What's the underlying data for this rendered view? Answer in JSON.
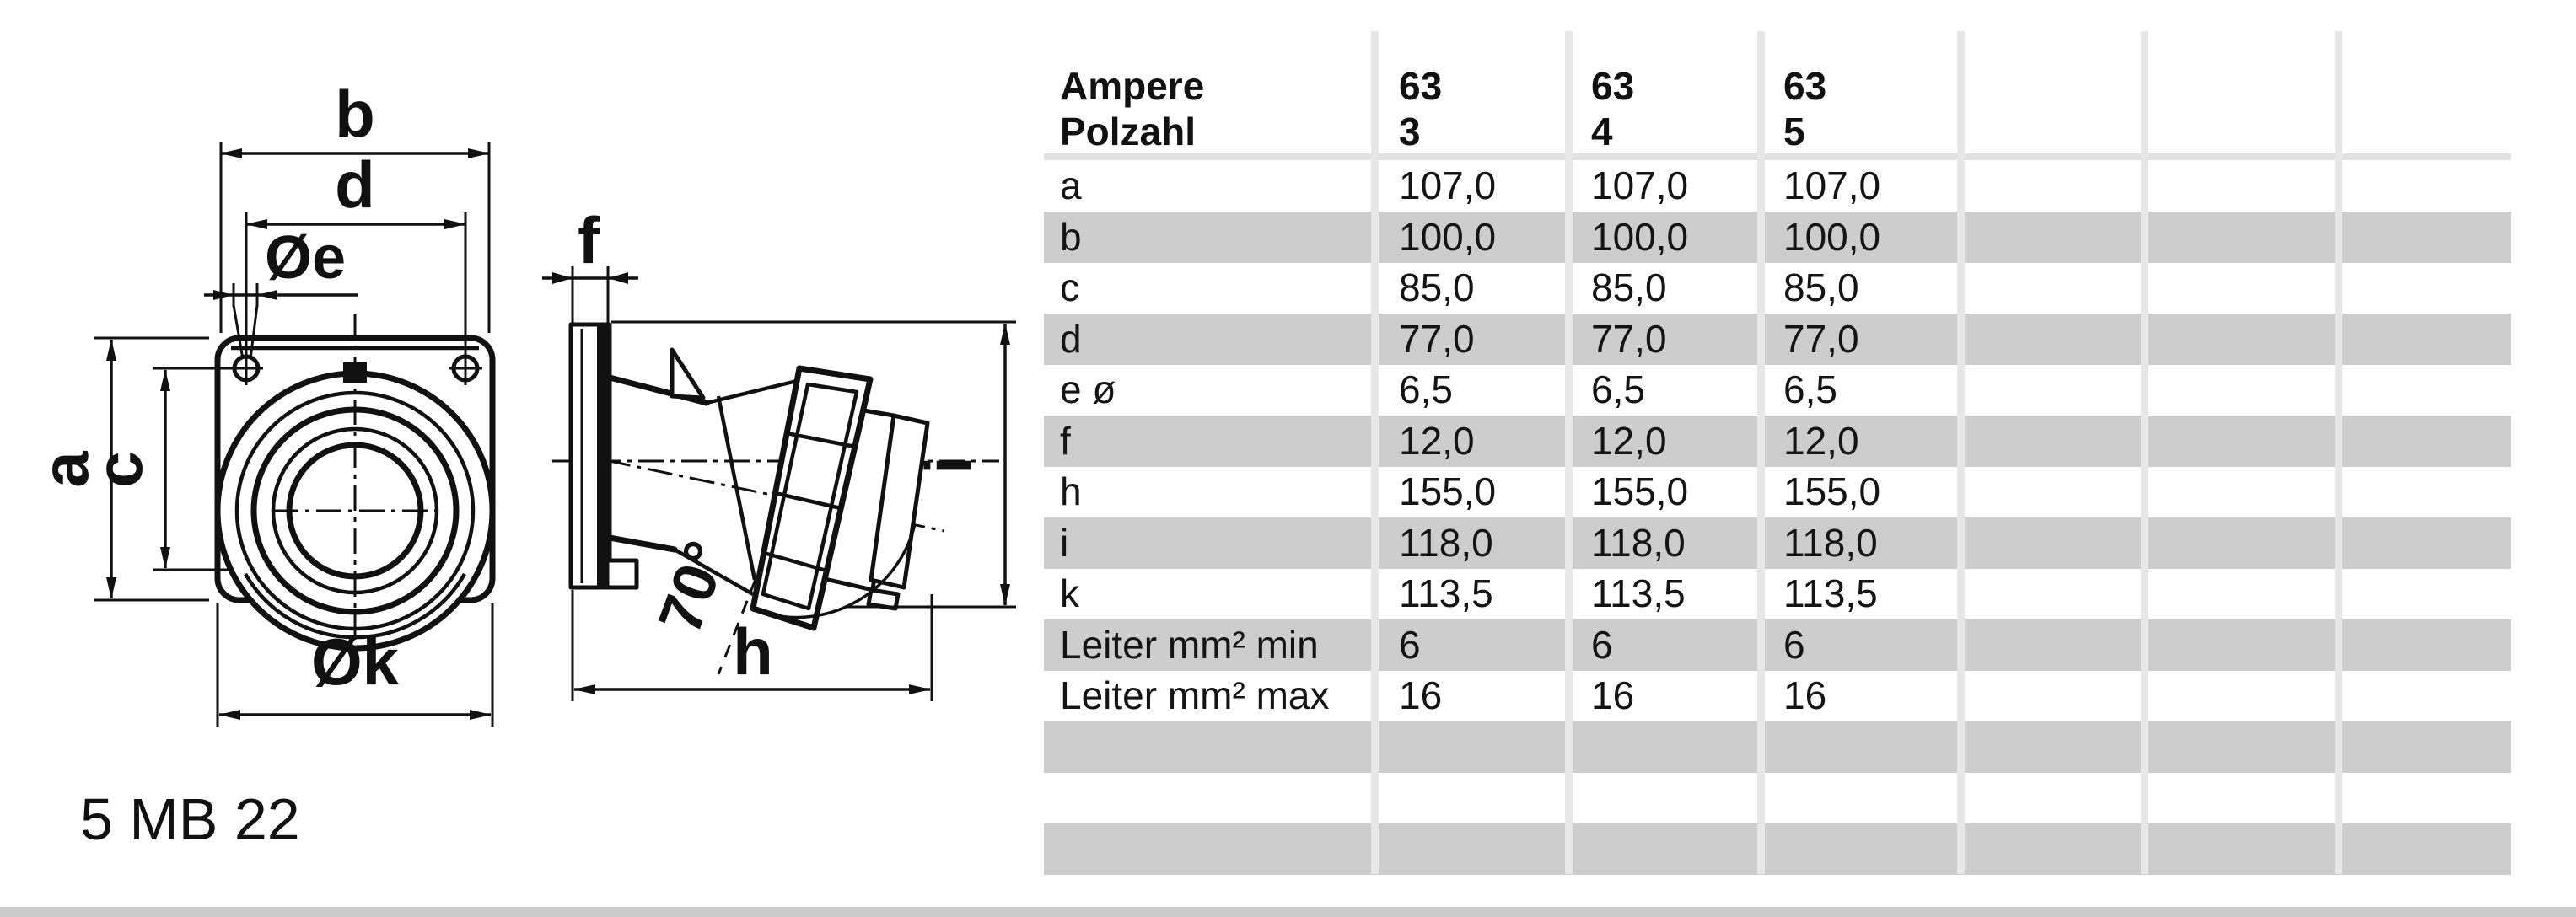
{
  "drawing": {
    "code": "5 MB 22",
    "labels": {
      "b": "b",
      "d": "d",
      "oe": "Øe",
      "f": "f",
      "a": "a",
      "c": "c",
      "ok": "Øk",
      "h": "h",
      "i": "i",
      "angle": "70°"
    }
  },
  "table": {
    "header": {
      "row1_label": "Ampere",
      "row2_label": "Polzahl",
      "columns": [
        {
          "ampere": "63",
          "polzahl": "3"
        },
        {
          "ampere": "63",
          "polzahl": "4"
        },
        {
          "ampere": "63",
          "polzahl": "5"
        }
      ]
    },
    "rows": [
      {
        "label": "a",
        "values": [
          "107,0",
          "107,0",
          "107,0"
        ]
      },
      {
        "label": "b",
        "values": [
          "100,0",
          "100,0",
          "100,0"
        ]
      },
      {
        "label": "c",
        "values": [
          "85,0",
          "85,0",
          "85,0"
        ]
      },
      {
        "label": "d",
        "values": [
          "77,0",
          "77,0",
          "77,0"
        ]
      },
      {
        "label": "e ø",
        "values": [
          "6,5",
          "6,5",
          "6,5"
        ]
      },
      {
        "label": "f",
        "values": [
          "12,0",
          "12,0",
          "12,0"
        ]
      },
      {
        "label": "h",
        "values": [
          "155,0",
          "155,0",
          "155,0"
        ]
      },
      {
        "label": "i",
        "values": [
          "118,0",
          "118,0",
          "118,0"
        ]
      },
      {
        "label": "k",
        "values": [
          "113,5",
          "113,5",
          "113,5"
        ]
      },
      {
        "label": "Leiter mm² min",
        "values": [
          "6",
          "6",
          "6"
        ]
      },
      {
        "label": "Leiter mm² max",
        "values": [
          "16",
          "16",
          "16"
        ]
      }
    ],
    "empty_row_count": 3,
    "colors": {
      "row_gray": "#cdcdcd",
      "separator": "#e7e7e7",
      "band": "#e2e2e2",
      "bottom_bar": "#cbcbcb"
    }
  }
}
